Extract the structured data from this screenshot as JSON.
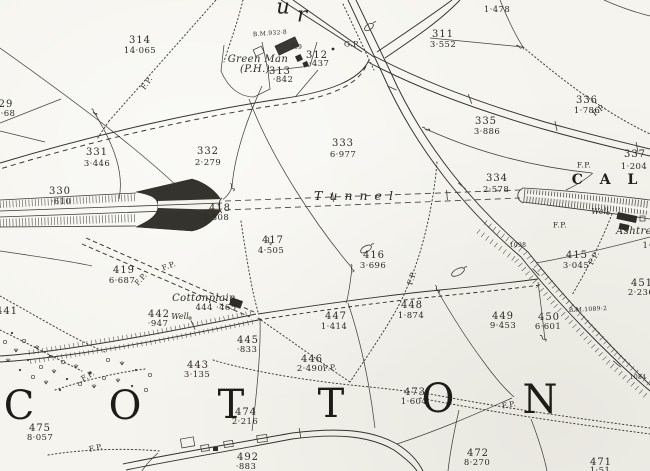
{
  "palette": {
    "paper": "#f5f4ee",
    "ink": "#33322c",
    "dark_feature": "#34332e"
  },
  "labels": [
    {
      "id": "bigletter-u",
      "text": "u",
      "x": 283,
      "y": 7,
      "cls": "ur"
    },
    {
      "id": "bigletter-r",
      "text": "r",
      "x": 302,
      "y": 15,
      "cls": "ur"
    },
    {
      "id": "area-310",
      "text": "1·478",
      "x": 497,
      "y": 10,
      "cls": "area"
    },
    {
      "id": "parcel-311",
      "text": "311",
      "x": 443,
      "y": 35,
      "cls": "parcel"
    },
    {
      "id": "area-311",
      "text": "3·552",
      "x": 443,
      "y": 45,
      "cls": "area"
    },
    {
      "id": "parcel-314",
      "text": "314",
      "x": 140,
      "y": 41,
      "cls": "parcel"
    },
    {
      "id": "area-314",
      "text": "14·065",
      "x": 140,
      "y": 51,
      "cls": "area"
    },
    {
      "id": "benchmark-932",
      "text": "B.M.932·8",
      "x": 270,
      "y": 34,
      "cls": "tiny",
      "rot": -4
    },
    {
      "id": "name-green-man",
      "text": "Green Man",
      "x": 258,
      "y": 60,
      "cls": "pname"
    },
    {
      "id": "name-ph",
      "text": "(P.H.)",
      "x": 255,
      "y": 70,
      "cls": "pname"
    },
    {
      "id": "parcel-313",
      "text": "313",
      "x": 280,
      "y": 72,
      "cls": "parcel"
    },
    {
      "id": "area-313",
      "text": "·842",
      "x": 283,
      "y": 80,
      "cls": "area"
    },
    {
      "id": "parcel-312",
      "text": "312",
      "x": 317,
      "y": 56,
      "cls": "parcel"
    },
    {
      "id": "area-312",
      "text": "·437",
      "x": 319,
      "y": 64,
      "cls": "area"
    },
    {
      "id": "label-gp",
      "text": "G.P.",
      "x": 352,
      "y": 44,
      "cls": "fp"
    },
    {
      "id": "tiny-709",
      "text": "709",
      "x": 296,
      "y": 48,
      "cls": "tiny"
    },
    {
      "id": "fp-northwest",
      "text": "F.P.",
      "x": 147,
      "y": 83,
      "cls": "fp",
      "rot": -55
    },
    {
      "id": "partial-329",
      "text": "29",
      "x": 6,
      "y": 105,
      "cls": "parcel"
    },
    {
      "id": "partial-329-area",
      "text": "·68",
      "x": 8,
      "y": 114,
      "cls": "area"
    },
    {
      "id": "parcel-336",
      "text": "336",
      "x": 587,
      "y": 101,
      "cls": "parcel"
    },
    {
      "id": "area-336",
      "text": "1·786",
      "x": 587,
      "y": 111,
      "cls": "area"
    },
    {
      "id": "fp-topright",
      "text": "F.P.",
      "x": 599,
      "y": 110,
      "cls": "fp",
      "rot": -38
    },
    {
      "id": "parcel-335",
      "text": "335",
      "x": 486,
      "y": 122,
      "cls": "parcel"
    },
    {
      "id": "area-335",
      "text": "3·886",
      "x": 487,
      "y": 132,
      "cls": "area"
    },
    {
      "id": "parcel-333",
      "text": "333",
      "x": 343,
      "y": 144,
      "cls": "parcel"
    },
    {
      "id": "area-333",
      "text": "6·977",
      "x": 343,
      "y": 155,
      "cls": "area"
    },
    {
      "id": "parcel-332",
      "text": "332",
      "x": 208,
      "y": 152,
      "cls": "parcel"
    },
    {
      "id": "area-332",
      "text": "2·279",
      "x": 208,
      "y": 163,
      "cls": "area"
    },
    {
      "id": "parcel-331",
      "text": "331",
      "x": 97,
      "y": 153,
      "cls": "parcel"
    },
    {
      "id": "area-331",
      "text": "3·446",
      "x": 97,
      "y": 164,
      "cls": "area"
    },
    {
      "id": "parcel-337",
      "text": "337",
      "x": 635,
      "y": 155,
      "cls": "parcel"
    },
    {
      "id": "area-337",
      "text": "1·204",
      "x": 634,
      "y": 167,
      "cls": "area"
    },
    {
      "id": "word-cald",
      "text": "C A L D",
      "x": 622,
      "y": 180,
      "cls": "cald"
    },
    {
      "id": "fp-portal",
      "text": "F.P.",
      "x": 584,
      "y": 165,
      "cls": "fp"
    },
    {
      "id": "parcel-334",
      "text": "334",
      "x": 497,
      "y": 179,
      "cls": "parcel"
    },
    {
      "id": "area-334",
      "text": "2·578",
      "x": 496,
      "y": 190,
      "cls": "area"
    },
    {
      "id": "parcel-330",
      "text": "330",
      "x": 60,
      "y": 192,
      "cls": "parcel"
    },
    {
      "id": "area-330",
      "text": "·610",
      "x": 61,
      "y": 202,
      "cls": "area"
    },
    {
      "id": "word-tunnel",
      "text": "Tunnel",
      "x": 357,
      "y": 196,
      "cls": "tunnel"
    },
    {
      "id": "parcel-418",
      "text": "418",
      "x": 220,
      "y": 209,
      "cls": "parcel"
    },
    {
      "id": "area-418",
      "text": "1·308",
      "x": 216,
      "y": 218,
      "cls": "area"
    },
    {
      "id": "name-well-ashtree",
      "text": "Well",
      "x": 600,
      "y": 212,
      "cls": "pname-sm"
    },
    {
      "id": "name-ashtree",
      "text": "Ashtre",
      "x": 634,
      "y": 232,
      "cls": "pname"
    },
    {
      "id": "fp-cutting",
      "text": "F.P.",
      "x": 560,
      "y": 225,
      "cls": "fp"
    },
    {
      "id": "parcel-417",
      "text": "417",
      "x": 273,
      "y": 241,
      "cls": "parcel"
    },
    {
      "id": "area-417",
      "text": "4·505",
      "x": 271,
      "y": 251,
      "cls": "area"
    },
    {
      "id": "tiny-1098",
      "text": "1098",
      "x": 518,
      "y": 246,
      "cls": "tiny"
    },
    {
      "id": "partial-right-1",
      "text": "1·",
      "x": 647,
      "y": 246,
      "cls": "area"
    },
    {
      "id": "parcel-416",
      "text": "416",
      "x": 374,
      "y": 256,
      "cls": "parcel"
    },
    {
      "id": "area-416",
      "text": "3·696",
      "x": 373,
      "y": 266,
      "cls": "area"
    },
    {
      "id": "parcel-415",
      "text": "415",
      "x": 577,
      "y": 256,
      "cls": "parcel"
    },
    {
      "id": "area-415",
      "text": "3·045",
      "x": 576,
      "y": 266,
      "cls": "area"
    },
    {
      "id": "fp-ashtree",
      "text": "F.P.",
      "x": 594,
      "y": 258,
      "cls": "fp",
      "rot": -60
    },
    {
      "id": "parcel-419",
      "text": "419",
      "x": 124,
      "y": 271,
      "cls": "parcel"
    },
    {
      "id": "area-419",
      "text": "6·687",
      "x": 122,
      "y": 281,
      "cls": "area"
    },
    {
      "id": "fp-track1",
      "text": "F.P.",
      "x": 141,
      "y": 279,
      "cls": "fp",
      "rot": -48
    },
    {
      "id": "fp-track2",
      "text": "F.P.",
      "x": 169,
      "y": 266,
      "cls": "fp",
      "rot": -20
    },
    {
      "id": "fp-mid",
      "text": "F.P.",
      "x": 412,
      "y": 278,
      "cls": "fp",
      "rot": -73
    },
    {
      "id": "parcel-451",
      "text": "451",
      "x": 642,
      "y": 284,
      "cls": "parcel"
    },
    {
      "id": "area-451",
      "text": "2·236",
      "x": 641,
      "y": 293,
      "cls": "area"
    },
    {
      "id": "name-cottonplain",
      "text": "Cottonplain",
      "x": 204,
      "y": 299,
      "cls": "pname"
    },
    {
      "id": "area-444",
      "text": "444 ·465",
      "x": 216,
      "y": 308,
      "cls": "area"
    },
    {
      "id": "name-well-cottonplain",
      "text": "Well",
      "x": 180,
      "y": 317,
      "cls": "pname-sm"
    },
    {
      "id": "parcel-448",
      "text": "448",
      "x": 412,
      "y": 306,
      "cls": "parcel"
    },
    {
      "id": "area-448",
      "text": "1·874",
      "x": 411,
      "y": 316,
      "cls": "area"
    },
    {
      "id": "benchmark-1089",
      "text": "B.M.1089·2",
      "x": 588,
      "y": 310,
      "cls": "tiny",
      "rot": -3
    },
    {
      "id": "partial-441",
      "text": "441",
      "x": 7,
      "y": 312,
      "cls": "parcel"
    },
    {
      "id": "parcel-442",
      "text": "442",
      "x": 159,
      "y": 315,
      "cls": "parcel"
    },
    {
      "id": "area-442",
      "text": "·947",
      "x": 158,
      "y": 324,
      "cls": "area"
    },
    {
      "id": "parcel-447",
      "text": "447",
      "x": 336,
      "y": 317,
      "cls": "parcel"
    },
    {
      "id": "area-447",
      "text": "1·414",
      "x": 334,
      "y": 327,
      "cls": "area"
    },
    {
      "id": "parcel-449",
      "text": "449",
      "x": 503,
      "y": 317,
      "cls": "parcel"
    },
    {
      "id": "area-449",
      "text": "9·453",
      "x": 503,
      "y": 326,
      "cls": "area"
    },
    {
      "id": "parcel-450",
      "text": "450",
      "x": 549,
      "y": 318,
      "cls": "parcel"
    },
    {
      "id": "area-450",
      "text": "6·601",
      "x": 548,
      "y": 327,
      "cls": "area"
    },
    {
      "id": "parcel-445",
      "text": "445",
      "x": 248,
      "y": 341,
      "cls": "parcel"
    },
    {
      "id": "area-445",
      "text": "·833",
      "x": 247,
      "y": 350,
      "cls": "area"
    },
    {
      "id": "parcel-446",
      "text": "446",
      "x": 312,
      "y": 360,
      "cls": "parcel"
    },
    {
      "id": "area-446",
      "text": "2·490",
      "x": 310,
      "y": 369,
      "cls": "area"
    },
    {
      "id": "fp-446",
      "text": "F.P.",
      "x": 330,
      "y": 368,
      "cls": "fp",
      "rot": -8
    },
    {
      "id": "parcel-443",
      "text": "443",
      "x": 198,
      "y": 366,
      "cls": "parcel"
    },
    {
      "id": "area-443",
      "text": "3·135",
      "x": 197,
      "y": 375,
      "cls": "area"
    },
    {
      "id": "fp-southwest1",
      "text": "F.P.",
      "x": 88,
      "y": 376,
      "cls": "fp",
      "rot": -30
    },
    {
      "id": "tiny-1084",
      "text": "1084",
      "x": 638,
      "y": 378,
      "cls": "tiny"
    },
    {
      "id": "parcel-473",
      "text": "473",
      "x": 415,
      "y": 393,
      "cls": "parcel"
    },
    {
      "id": "area-473",
      "text": "1·604",
      "x": 414,
      "y": 402,
      "cls": "area"
    },
    {
      "id": "fp-south",
      "text": "F.P.",
      "x": 509,
      "y": 405,
      "cls": "fp",
      "rot": -10
    },
    {
      "id": "bigletter-c",
      "text": "C",
      "x": 19,
      "y": 406,
      "cls": "big"
    },
    {
      "id": "bigletter-o1",
      "text": "O",
      "x": 125,
      "y": 406,
      "cls": "big"
    },
    {
      "id": "bigletter-t1",
      "text": "T",
      "x": 231,
      "y": 405,
      "cls": "big"
    },
    {
      "id": "bigletter-t2",
      "text": "T",
      "x": 331,
      "y": 404,
      "cls": "big"
    },
    {
      "id": "bigletter-o2",
      "text": "O",
      "x": 438,
      "y": 399,
      "cls": "big"
    },
    {
      "id": "bigletter-n",
      "text": "N",
      "x": 540,
      "y": 400,
      "cls": "big"
    },
    {
      "id": "parcel-474",
      "text": "474",
      "x": 246,
      "y": 413,
      "cls": "parcel"
    },
    {
      "id": "area-474",
      "text": "2·216",
      "x": 245,
      "y": 422,
      "cls": "area"
    },
    {
      "id": "parcel-475",
      "text": "475",
      "x": 40,
      "y": 429,
      "cls": "parcel"
    },
    {
      "id": "area-475",
      "text": "8·057",
      "x": 40,
      "y": 438,
      "cls": "area"
    },
    {
      "id": "fp-southwest2",
      "text": "F.P.",
      "x": 96,
      "y": 448,
      "cls": "fp",
      "rot": -12
    },
    {
      "id": "parcel-472",
      "text": "472",
      "x": 478,
      "y": 454,
      "cls": "parcel"
    },
    {
      "id": "area-472",
      "text": "8·270",
      "x": 477,
      "y": 463,
      "cls": "area"
    },
    {
      "id": "parcel-492",
      "text": "492",
      "x": 248,
      "y": 458,
      "cls": "parcel"
    },
    {
      "id": "area-492",
      "text": "·883",
      "x": 246,
      "y": 467,
      "cls": "area"
    },
    {
      "id": "parcel-471",
      "text": "471",
      "x": 601,
      "y": 463,
      "cls": "parcel"
    },
    {
      "id": "area-471",
      "text": "1·51",
      "x": 600,
      "y": 471,
      "cls": "area"
    }
  ]
}
